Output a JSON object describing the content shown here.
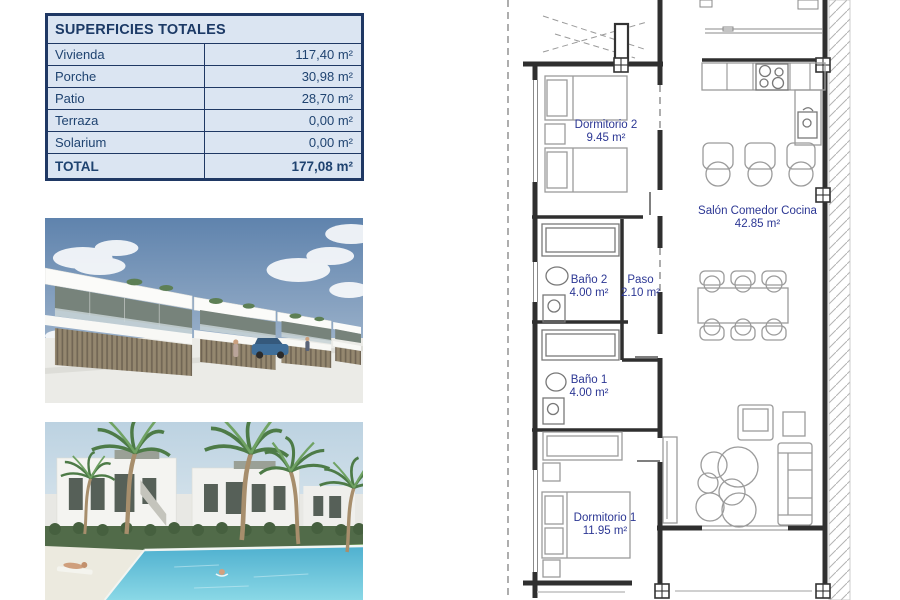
{
  "surfaces_table": {
    "title": "SUPERFICIES TOTALES",
    "rows": [
      {
        "label": "Vivienda",
        "value": "117,40 m²"
      },
      {
        "label": "Porche",
        "value": "30,98 m²"
      },
      {
        "label": "Patio",
        "value": "28,70 m²"
      },
      {
        "label": "Terraza",
        "value": "0,00 m²"
      },
      {
        "label": "Solarium",
        "value": "0,00 m²"
      }
    ],
    "total": {
      "label": "TOTAL",
      "value": "177,08 m²"
    },
    "colors": {
      "border": "#1f3864",
      "cell_bg": "#dbe5f2",
      "text": "#1f4370"
    }
  },
  "floor_plan": {
    "label_color": "#2c3794",
    "rooms": [
      {
        "name": "Dormitorio 2",
        "area": "9.45 m²"
      },
      {
        "name": "Salón Comedor Cocina",
        "area": "42.85 m²"
      },
      {
        "name": "Baño 2",
        "area": "4.00 m²"
      },
      {
        "name": "Paso",
        "area": "2.10 m²"
      },
      {
        "name": "Baño 1",
        "area": "4.00 m²"
      },
      {
        "name": "Dormitorio 1",
        "area": "11.95 m²"
      }
    ]
  },
  "photos": [
    {
      "description": "Exterior render: row of modern white terraced townhouses with balconies, wooden slat fences, street with car and pedestrians"
    },
    {
      "description": "Render: communal swimming pool with palm trees, sunbather, swimmer and white apartment blocks behind a green hedge"
    }
  ]
}
